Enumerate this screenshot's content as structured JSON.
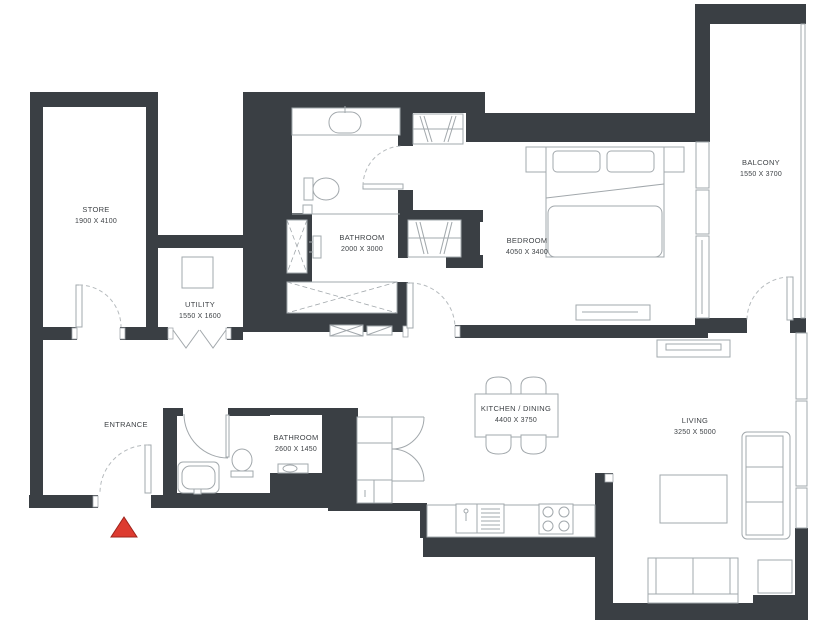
{
  "plan": {
    "type": "apartment-floor-plan",
    "background_color": "#ffffff",
    "wall_color": "#3a3f44",
    "fixture_line_color": "#a2a8ac",
    "text_color": "#3f4347",
    "entrance_marker_color": "#dd3b30",
    "rooms": [
      {
        "id": "store",
        "name": "STORE",
        "dims": "1900 X 4100"
      },
      {
        "id": "utility",
        "name": "UTILITY",
        "dims": "1550 X 1600"
      },
      {
        "id": "bathroom-1",
        "name": "BATHROOM",
        "dims": "2000 X 3000"
      },
      {
        "id": "bedroom",
        "name": "BEDROOM",
        "dims": "4050 X 3400"
      },
      {
        "id": "balcony",
        "name": "BALCONY",
        "dims": "1550 X 3700"
      },
      {
        "id": "entrance",
        "name": "ENTRANCE",
        "dims": ""
      },
      {
        "id": "bathroom-2",
        "name": "BATHROOM",
        "dims": "2600 X 1450"
      },
      {
        "id": "kitchen-dining",
        "name": "KITCHEN / DINING",
        "dims": "4400 X 3750"
      },
      {
        "id": "living",
        "name": "LIVING",
        "dims": "3250 X 5000"
      }
    ]
  }
}
